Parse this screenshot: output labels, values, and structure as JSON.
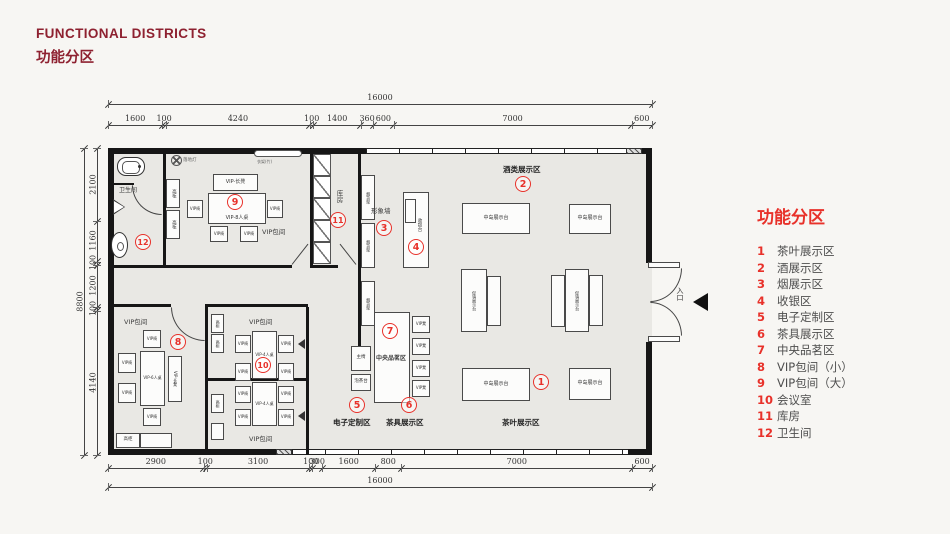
{
  "header": {
    "title_en": "FUNCTIONAL DISTRICTS",
    "title_zh": "功能分区"
  },
  "colors": {
    "accent_red": "#e8312a",
    "title_maroon": "#8e2130",
    "wall_black": "#161616",
    "floor_gray": "#e9e8e4"
  },
  "legend": {
    "title": "功能分区",
    "items": [
      {
        "num": "1",
        "label": "茶叶展示区"
      },
      {
        "num": "2",
        "label": "酒展示区"
      },
      {
        "num": "3",
        "label": "烟展示区"
      },
      {
        "num": "4",
        "label": "收银区"
      },
      {
        "num": "5",
        "label": "电子定制区"
      },
      {
        "num": "6",
        "label": "茶具展示区"
      },
      {
        "num": "7",
        "label": "中央品茗区"
      },
      {
        "num": "8",
        "label": "VIP包间（小）"
      },
      {
        "num": "9",
        "label": "VIP包间（大）"
      },
      {
        "num": "10",
        "label": "会议室"
      },
      {
        "num": "11",
        "label": "库房"
      },
      {
        "num": "12",
        "label": "卫生间"
      }
    ]
  },
  "dimensions": {
    "top_segments": [
      1600,
      100,
      4240,
      100,
      1400,
      360,
      600,
      7000,
      600
    ],
    "top_total": [
      16000
    ],
    "bottom_segments": [
      2900,
      100,
      3100,
      100,
      300,
      1600,
      800,
      7000,
      600
    ],
    "bottom_total": [
      16000
    ],
    "left_segments": [
      2100,
      1160,
      100,
      1200,
      100,
      4140
    ],
    "left_total": [
      8800
    ]
  },
  "plan": {
    "marker_numbers": [
      "1",
      "2",
      "3",
      "4",
      "5",
      "6",
      "7",
      "8",
      "9",
      "10",
      "11",
      "12"
    ],
    "zones": {
      "wine": "酒类展示区",
      "tea": "茶叶展示区",
      "e_custom": "电子定制区",
      "teaware": "茶具展示区",
      "toilet": "卫生间",
      "storage": "库房",
      "image_wall": "形象墙",
      "vip_room": "VIP包间",
      "central_tea": "中央品茗区",
      "entrance": "入口"
    },
    "labels": {
      "vip_chair": "VIP椅",
      "vip_stool": "VIP凳",
      "vip_bench": "VIP-长凳",
      "vip_table_8": "VIP-8人桌",
      "vip_table_6": "VIP-6人桌",
      "vip_table_4": "VIP-4人桌",
      "tall_cabinet": "高柜",
      "island_display": "中岛展示台",
      "promo_display": "促销展示台",
      "cig_rack": "烟货架",
      "cashier": "收银台",
      "main_chair": "主椅",
      "tea_station": "泡茶台",
      "floor_lamp": "落地灯",
      "hanger_rack": "衣架(竹)"
    }
  }
}
